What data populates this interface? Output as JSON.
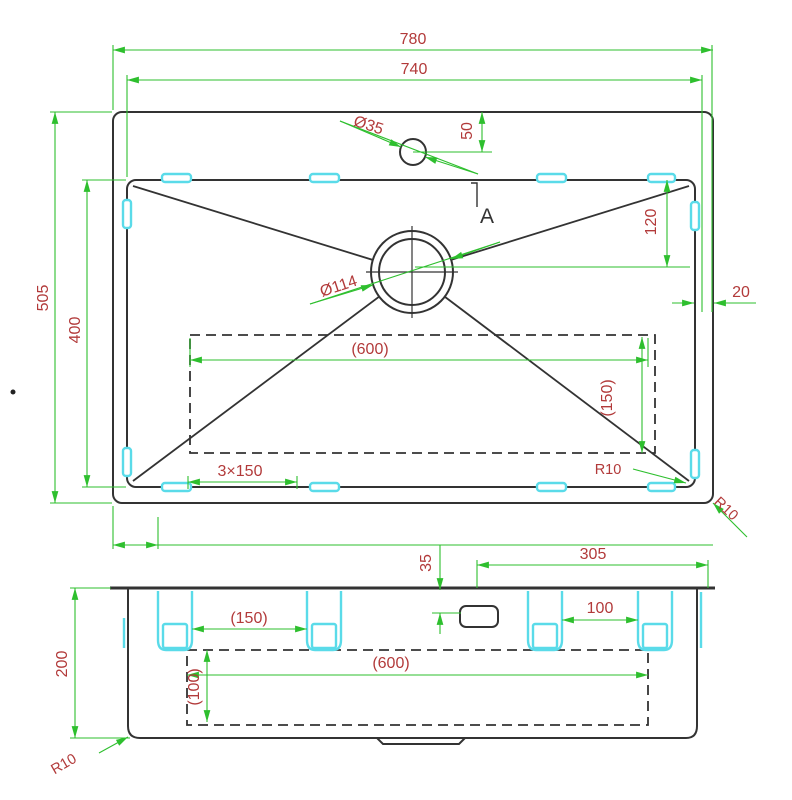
{
  "title": "sink-technical-drawing",
  "colors": {
    "dim-green": "#2ebf2e",
    "dim-red": "#b23a3a",
    "clip-cyan": "#5adbe9",
    "line-dark": "#333333",
    "bg": "#ffffff"
  },
  "top_view": {
    "dim_outer_width": "780",
    "dim_inner_width": "740",
    "dim_outer_height": "505",
    "dim_inner_height": "400",
    "dim_faucet_offset": "50",
    "dia_faucet": "Ø35",
    "dia_drain": "Ø114",
    "dim_drain_offset": "120",
    "dim_rim_gap": "20",
    "dim_pad_width": "(600)",
    "dim_pad_height": "(150)",
    "dim_clip_pitch": "3×150",
    "radius_bowl_corner": "R10",
    "radius_outer_corner": "R10",
    "section_marker": "A"
  },
  "side_view": {
    "dim_depth": "200",
    "dim_faucet_to_edge": "305",
    "dim_faucet_inset": "35",
    "dim_clip_span_left": "(150)",
    "dim_clip_span_right": "100",
    "dim_pad_width": "(600)",
    "dim_pad_height": "(100)",
    "radius_bottom_corner": "R10"
  }
}
